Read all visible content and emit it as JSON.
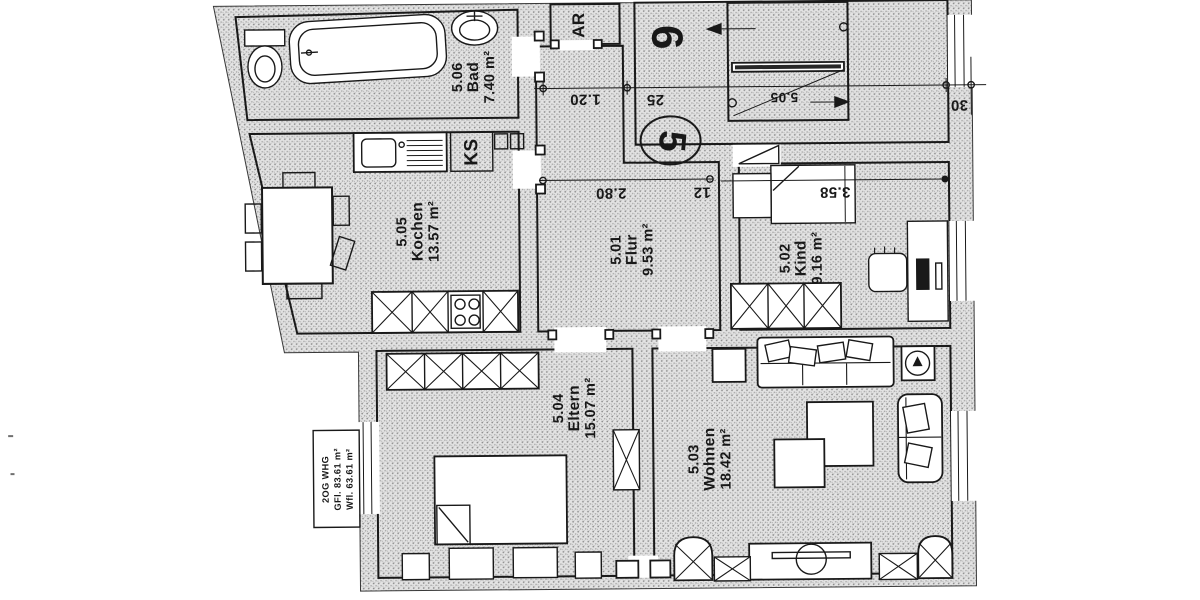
{
  "document": {
    "type": "scanned apartment floor plan"
  },
  "colors": {
    "ink": "#1c1c1c",
    "wall_dot": "#8f8f8f",
    "paper": "#ffffff"
  },
  "rooms": [
    {
      "number": "5.06",
      "name": "Bad",
      "area": "7.40 m²"
    },
    {
      "number": "5.05",
      "name": "Kochen",
      "area": "13.57 m²"
    },
    {
      "number": "5.01",
      "name": "Flur",
      "area": "9.53 m²"
    },
    {
      "number": "5.02",
      "name": "Kind",
      "area": "9.16 m²"
    },
    {
      "number": "5.04",
      "name": "Eltern",
      "area": "15.07 m²"
    },
    {
      "number": "5.03",
      "name": "Wohnen",
      "area": "18.42 m²"
    }
  ],
  "annotations": {
    "storage": "AR",
    "fridge": "KS",
    "unit_top": "6",
    "unit_entry": "5",
    "stair_label": "5.05"
  },
  "dimensions": {
    "hall_width": "1.20",
    "wall_a": "25",
    "wall_b": "12",
    "wall_c": "30",
    "flur_width": "2.80",
    "kind_width": "3.58"
  },
  "info_box": {
    "line1": "2OG WHG",
    "line2": "GFl. 83.61 m²",
    "line3": "Wfl. 63.61 m²"
  }
}
